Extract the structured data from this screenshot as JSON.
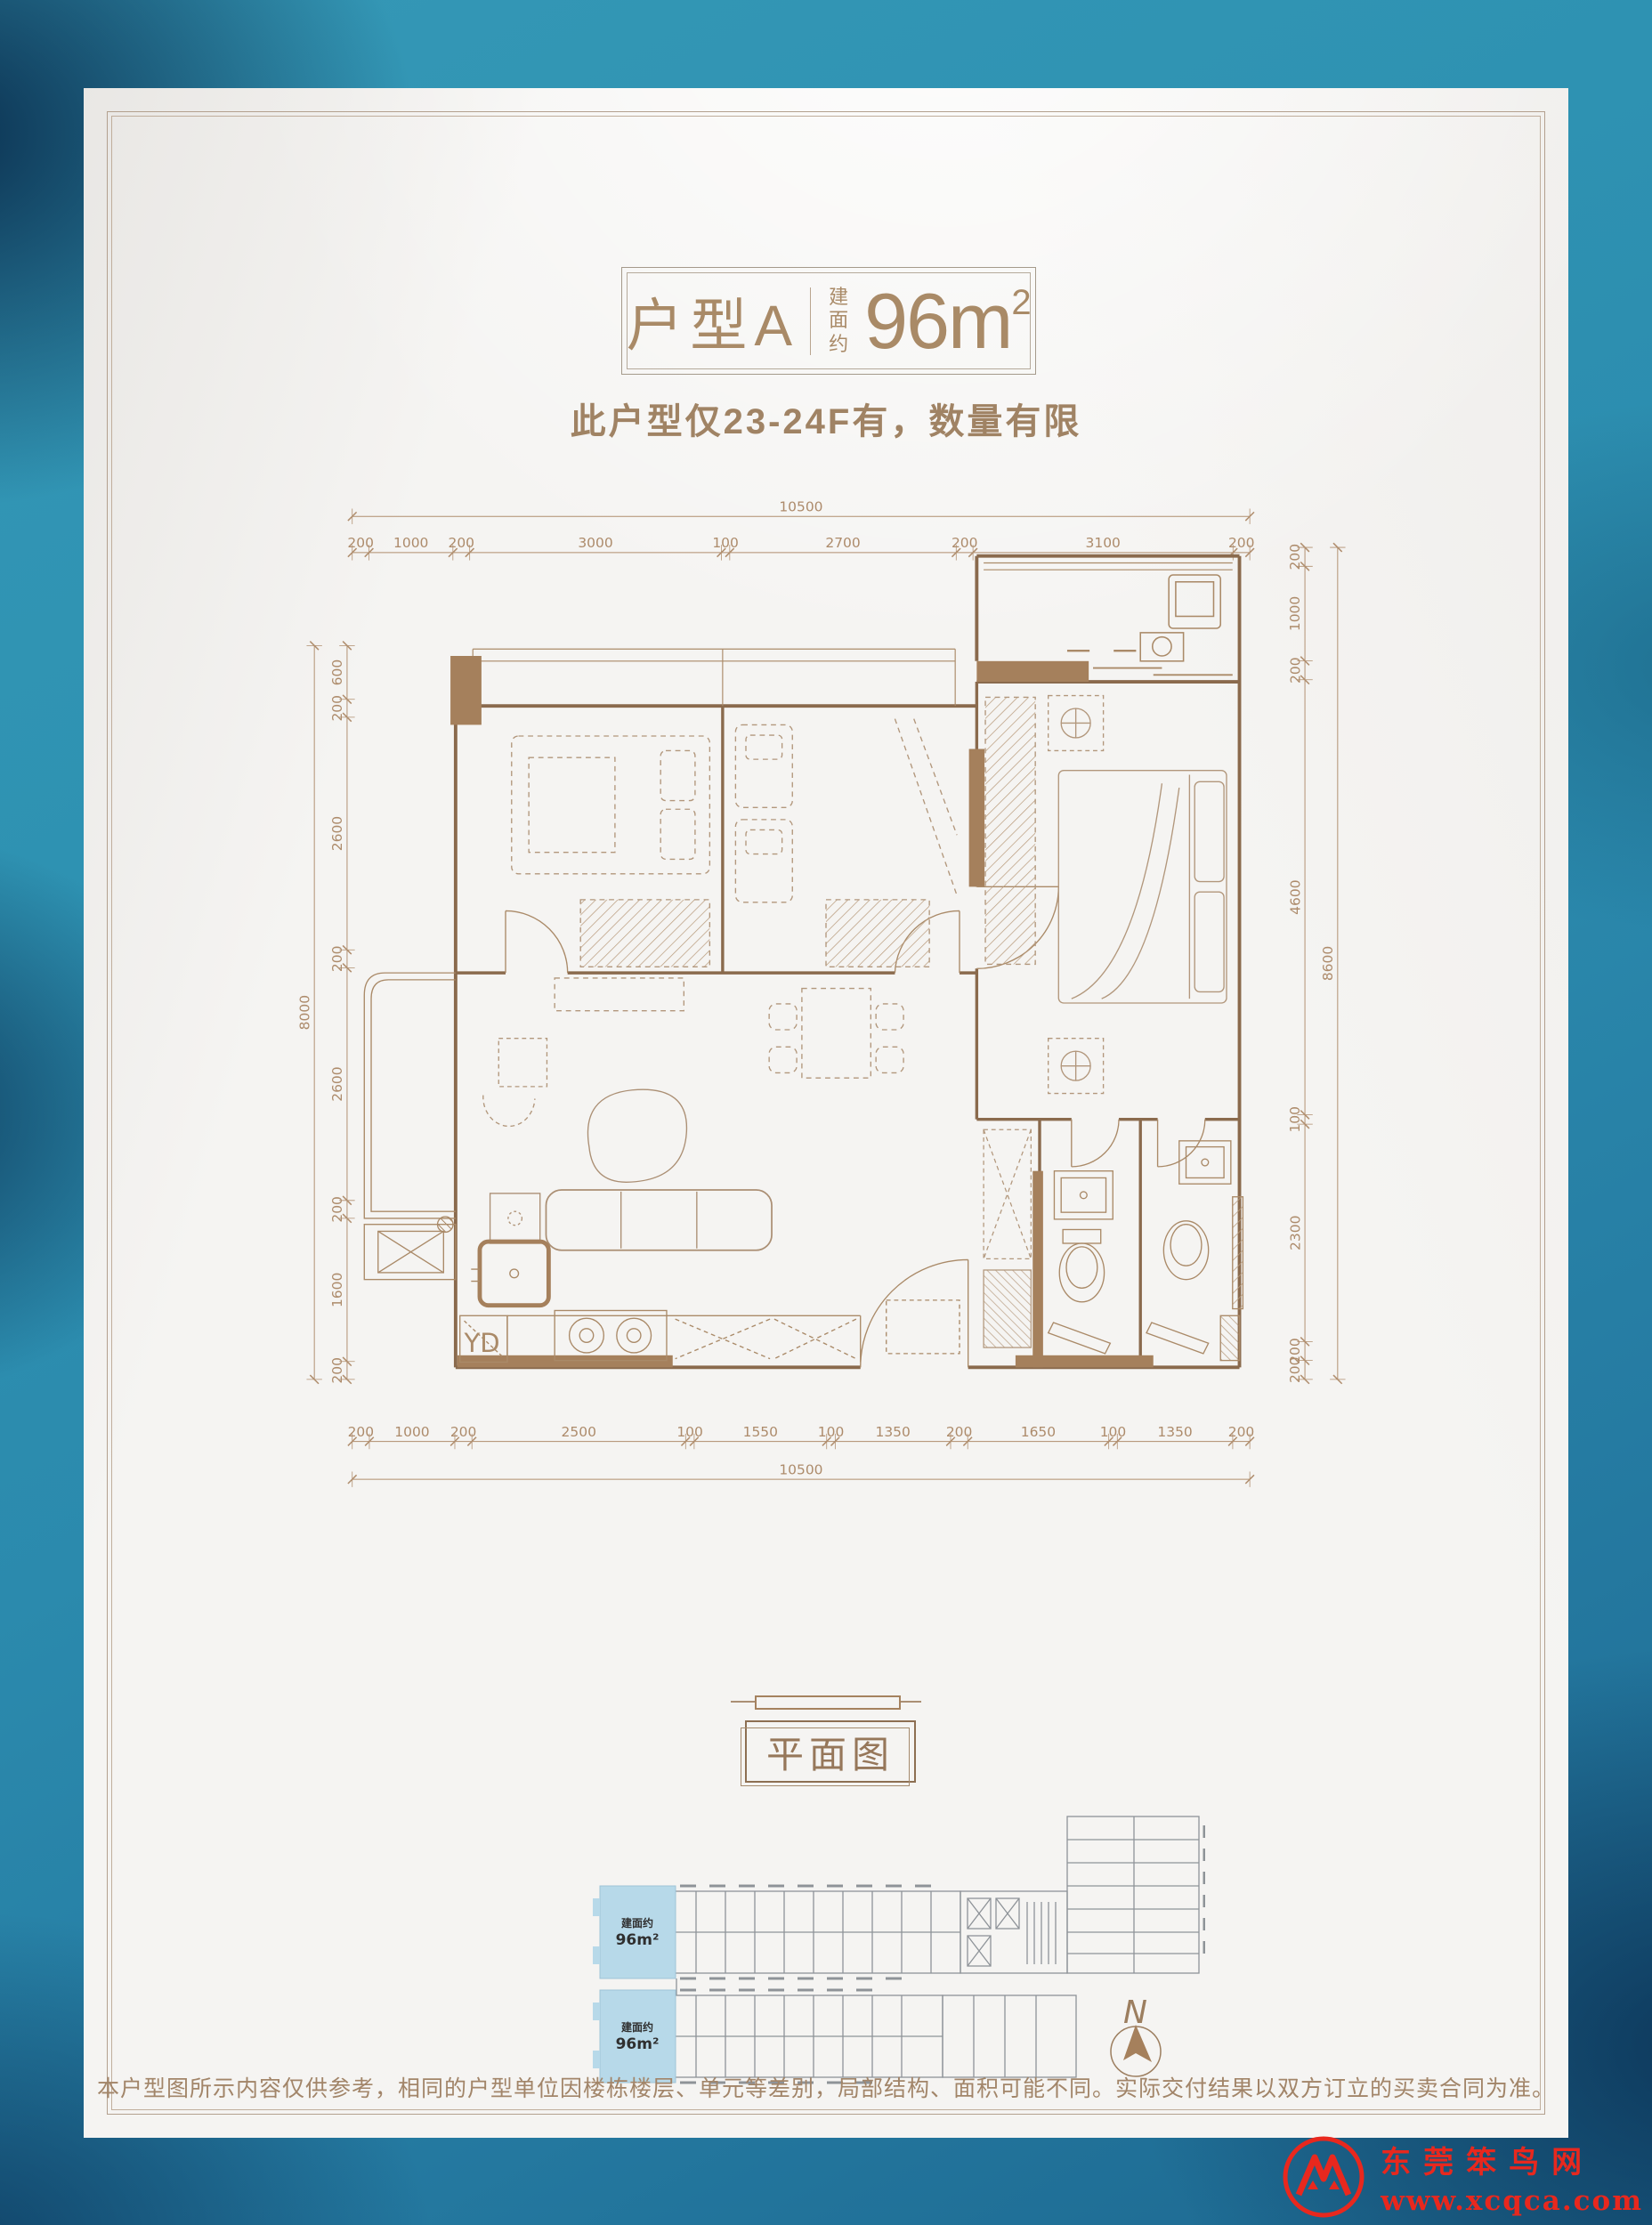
{
  "poster": {
    "title": {
      "unit_label": "户型A",
      "area_prefix": "建面约",
      "area_value": "96m",
      "area_sup": "2"
    },
    "subtitle": "此户型仅23-24F有，数量有限",
    "section_label": "平面图",
    "disclaimer": "本户型图所示内容仅供参考，相同的户型单位因楼栋楼层、单元等差别，局部结构、面积可能不同。实际交付结果以双方订立的买卖合同为准。"
  },
  "floor_plan": {
    "dimensions": {
      "top": {
        "overall": "10500",
        "segments": [
          "200",
          "1000",
          "200",
          "3000",
          "100",
          "2700",
          "200",
          "3100",
          "200"
        ]
      },
      "bottom": {
        "overall": "10500",
        "segments": [
          "200",
          "1000",
          "200",
          "2500",
          "100",
          "1550",
          "100",
          "1350",
          "200",
          "1650",
          "100",
          "1350",
          "200"
        ]
      },
      "left": {
        "overall": "8000",
        "segments": [
          "600",
          "200",
          "2600",
          "200",
          "2600",
          "200",
          "1600",
          "200"
        ]
      },
      "right": {
        "overall": "8600",
        "segments": [
          "200",
          "1000",
          "200",
          "4600",
          "100",
          "2300",
          "200",
          "200"
        ]
      }
    },
    "labels": {
      "flue": "YD"
    }
  },
  "key_plan": {
    "units": [
      {
        "prefix": "建面约",
        "area": "96m²"
      },
      {
        "prefix": "建面约",
        "area": "96m²"
      }
    ],
    "north_label": "N"
  },
  "watermark": {
    "site_name": "东莞笨鸟网",
    "site_url": "www.xcqca.com"
  },
  "colors": {
    "accent_brown": "#a5825f",
    "wall_brown": "#8a6a4d",
    "dim_line": "#b08e6e",
    "frame": "#b3a08e",
    "highlight_blue": "#b7d9e9",
    "bg_teal": "#2e92b2",
    "watermark_red": "#e8281e"
  }
}
